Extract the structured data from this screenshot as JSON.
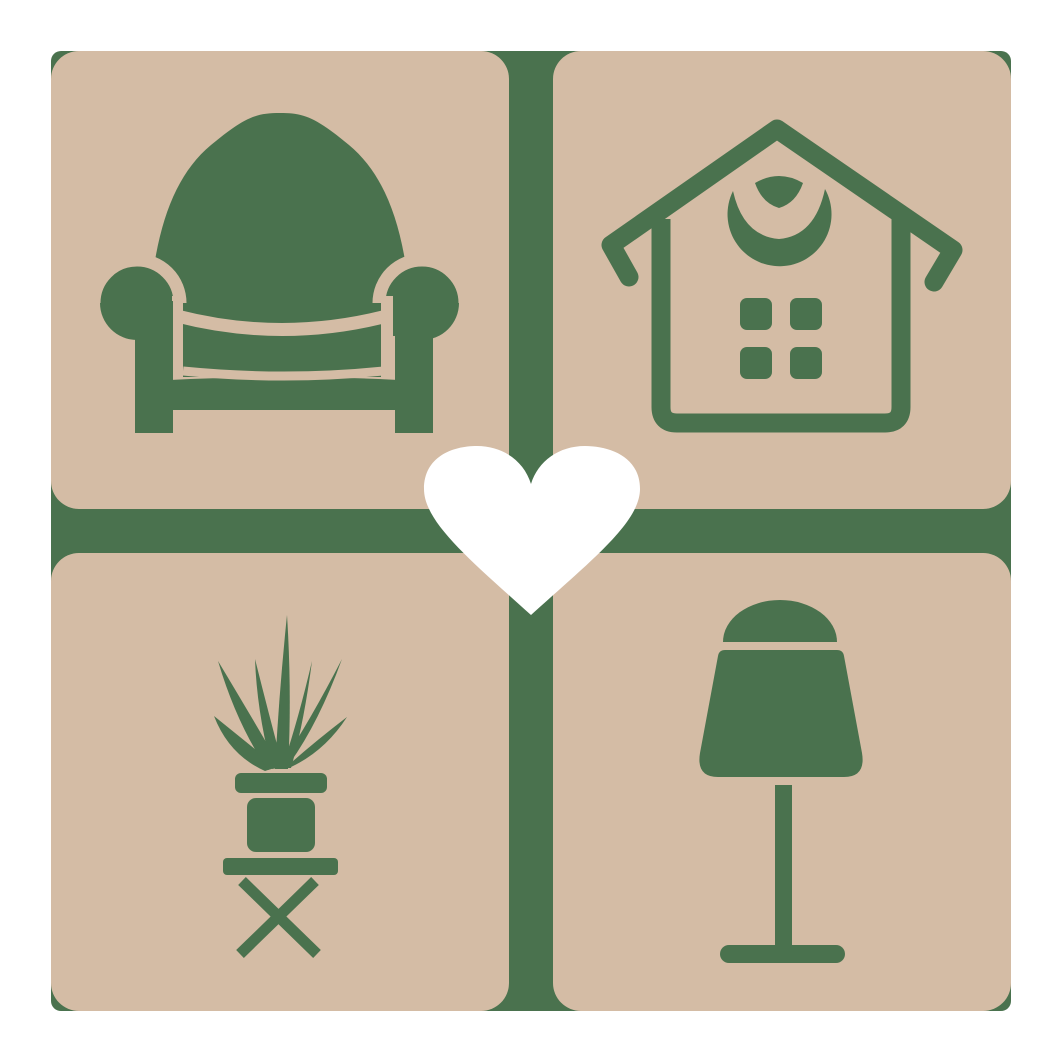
{
  "logo": {
    "description": "Home and furniture logo: four rounded beige tiles on a green backing forming a 2x2 grid separated by a green cross, each tile holding a green furniture silhouette, with a white heart at the center",
    "colors": {
      "tile_tan": "#d4bca5",
      "icon_green": "#4a724e",
      "heart_white": "#ffffff",
      "page_background": "#ffffff"
    },
    "grid": {
      "rows": 2,
      "cols": 2,
      "gap_px": 44,
      "outer_size_px": 960
    },
    "tiles": [
      {
        "position": "top-left",
        "subject": "armchair",
        "icon": "armchair-icon"
      },
      {
        "position": "top-right",
        "subject": "house with windows and round gable ornament",
        "icon": "house-icon"
      },
      {
        "position": "bottom-left",
        "subject": "potted plant on cross-legged stool",
        "icon": "potted-plant-icon"
      },
      {
        "position": "bottom-right",
        "subject": "table lamp",
        "icon": "table-lamp-icon"
      }
    ],
    "center_icon": "heart-icon"
  }
}
